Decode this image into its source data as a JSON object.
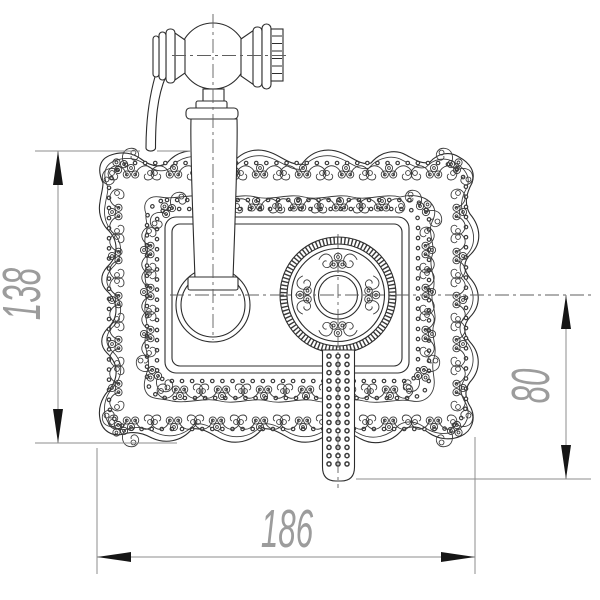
{
  "figure": {
    "type": "technical-dimension-drawing",
    "dimensions": {
      "height_label": "138",
      "width_label": "186",
      "lever_label": "80"
    },
    "colors": {
      "background": "#ffffff",
      "outline": "#2c2c2c",
      "ornament": "#3a3a3a",
      "dimension_line": "#8d8d8d",
      "dimension_text": "#9c9c9c",
      "arrowhead": "#161616",
      "centerline": "#5f5f5f"
    }
  }
}
